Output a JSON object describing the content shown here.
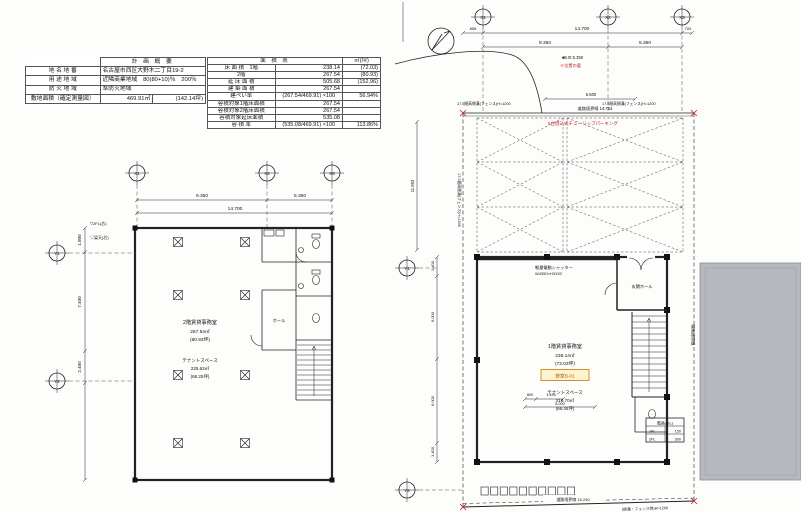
{
  "colors": {
    "line": "#222222",
    "red_annotation": "#c42222",
    "orange_tag_border": "#cc8822",
    "orange_tag_bg": "#fdf3cf",
    "orange_tag_text": "#a96410",
    "neighbor_gray": "#b5b9bd"
  },
  "summary_table": {
    "title": "計 画 概 要",
    "rows": [
      {
        "label": "地 名 地 番",
        "value": "名古屋市西区大野木二丁目19-2",
        "extra": ""
      },
      {
        "label": "用 途 地 域",
        "value": "近隣商業地域　80(80+10)％　200％",
        "extra": ""
      },
      {
        "label": "防 火 地 域",
        "value": "準防火地域",
        "extra": ""
      },
      {
        "label": "敷地面積（確定測量図）",
        "value": "469.91㎡",
        "extra": "(142.14坪)"
      }
    ]
  },
  "area_table": {
    "title": "面 積 表",
    "unit": "㎡(坪)",
    "rows": [
      {
        "label": "床 面 積　1階",
        "value": "238.14",
        "right": "(72.03)"
      },
      {
        "label": "2階",
        "value": "267.54",
        "right": "(80.93)"
      },
      {
        "label": "延 床 面 積",
        "value": "505.68",
        "right": "(152.96)"
      },
      {
        "label": "建 築 面 積",
        "value": "267.54",
        "right": ""
      },
      {
        "label": "建ぺい率",
        "value": "(267.54/469.91) ×100",
        "right": "56.94%"
      },
      {
        "label": "容積対象1階床面積",
        "value": "267.54",
        "right": ""
      },
      {
        "label": "容積対象2階床面積",
        "value": "267.54",
        "right": ""
      },
      {
        "label": "容積対象延床面積",
        "value": "535.08",
        "right": ""
      },
      {
        "label": "容 積 率",
        "value": "(535.08/469.91) ×100",
        "right": "113.86%"
      }
    ]
  },
  "plan2f": {
    "grid_x": [
      "X1",
      "X2",
      "X3"
    ],
    "grid_y": [
      "Y1",
      "Y2"
    ],
    "dim_total": "14.700",
    "dim_left": "9.350",
    "dim_right": "5.350",
    "dim_v": [
      "1.800",
      "7.400",
      "2.400"
    ],
    "level_a": "▽2FL(芯)",
    "level_b": "▽梁天(芯)",
    "hall": "ホール",
    "room_title": "2階賃貸事務室",
    "room_area": "267.54㎡",
    "room_tsubo": "(80.93坪)",
    "tenant_title": "テナントスペース",
    "tenant_area": "225.63㎡",
    "tenant_tsubo": "(68.25坪)"
  },
  "plan1f": {
    "grid_x": [
      "X1",
      "X2",
      "X3"
    ],
    "grid_y": [
      "Y1",
      "Y2"
    ],
    "dim_855": "855",
    "dim_total": "14.700",
    "dim_700": "700",
    "dim_left": "9.350",
    "dim_right": "5.350",
    "dim_6500": "6.500",
    "dim_11953": "11.953",
    "dim_v": [
      "1.400",
      "6.000",
      "6.000",
      "1.400"
    ],
    "dim_800": "800",
    "dim_1455": "1.455",
    "dim_5000": "5.000",
    "note_black": "■5.0t 5.350",
    "note_red": "※位置の要",
    "parking_label": "5台借込式チューリップパーキング",
    "road_top": "道路境界線 14.754",
    "road_bottom": "道路境界線 15.240",
    "fence_label": "17.5間高側溝(フェンス)H=1200",
    "fence_bottom": "(側溝・フェンス等)H=1200",
    "neighbor_boundary": "隣地境界線",
    "shutter": "軽量電動シャッター",
    "shutter_size": "W4350×H3150",
    "entrance": "玄関ホール",
    "room_title": "1階賃貸事務室",
    "room_area": "238.14㎡",
    "room_tsubo": "(72.03坪)",
    "unit_tag": "貸室B-01",
    "tenant_title": "テナントスペース",
    "tenant_area": "219.70㎡",
    "tenant_tsubo": "(66.45坪)",
    "level_table": {
      "header": "階高(GL)",
      "rows": [
        {
          "label": "1FL",
          "value": "150"
        },
        {
          "label": "2FL",
          "value": "300"
        }
      ]
    }
  }
}
